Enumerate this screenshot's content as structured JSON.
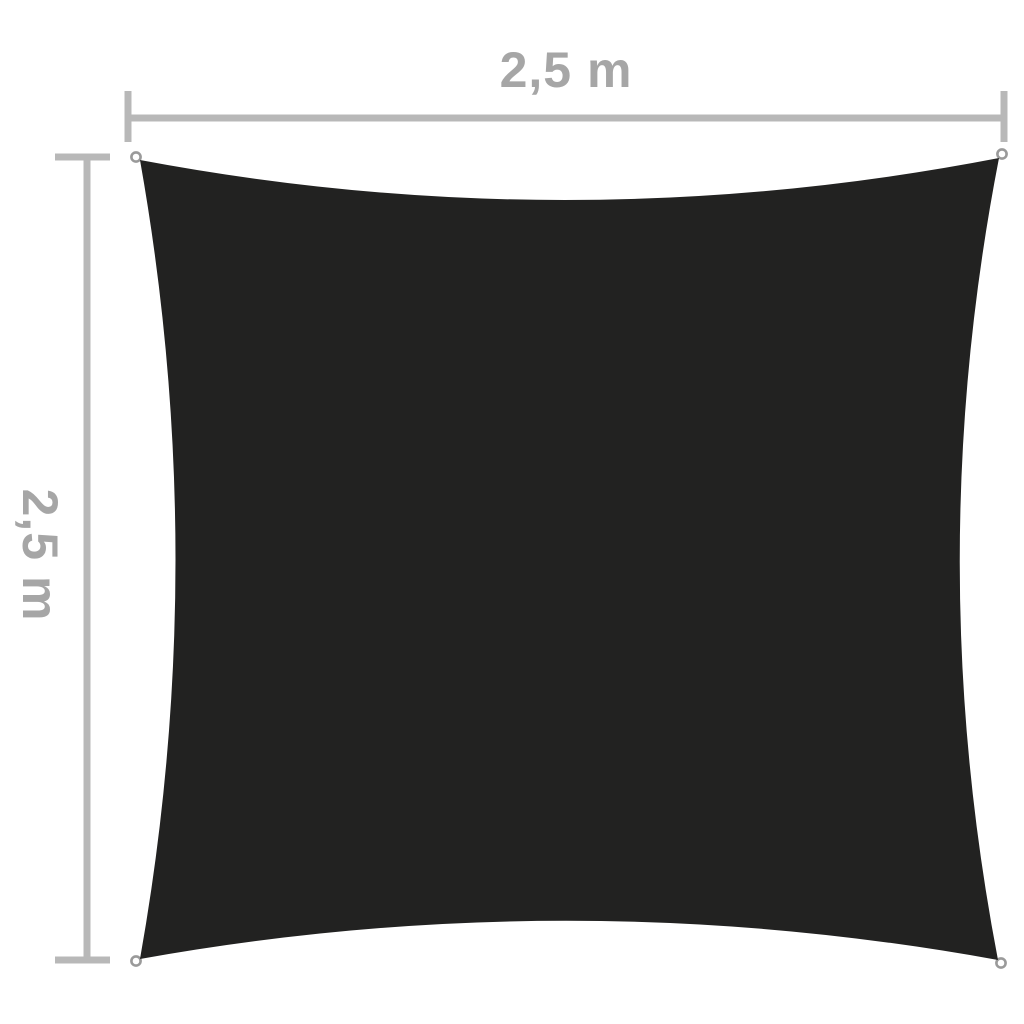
{
  "diagram": {
    "description": "Square shade sail product dimension diagram",
    "background_color": "#ffffff",
    "sail_color": "#222221",
    "line_color": "#b8b8b8",
    "label_color": "#a6a6a6",
    "grommet_ring_color": "#9a9a9a",
    "grommet_fill_color": "#ffffff",
    "width_dimension": {
      "label": "2,5 m"
    },
    "height_dimension": {
      "label": "2,5 m"
    }
  }
}
